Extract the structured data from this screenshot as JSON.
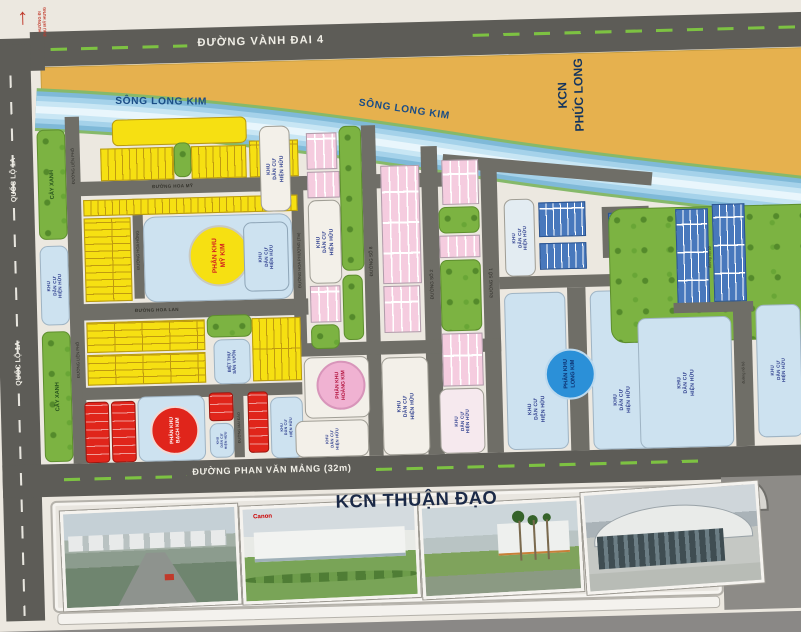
{
  "sign": {
    "arrow": "↑",
    "l1": "HƯỚNG ĐI",
    "l2": "PHÚ MỸ HƯNG"
  },
  "roads": {
    "vanh_dai_4": "ĐƯỜNG VÀNH ĐAI 4",
    "quoc_lo_1a": "QUỐC LỘ 1A",
    "phan_van_mang": "ĐƯỜNG PHAN VĂN MẢNG (32m)",
    "hoa_my": "ĐƯỜNG HOA MỸ",
    "hoa_lan": "ĐƯỜNG HOA LAN",
    "hoa_hong": "ĐƯỜNG HOA HỒNG",
    "hoa_phuong": "ĐƯỜNG HOA PHƯỢNG (7m)",
    "so_1": "ĐƯỜNG SỐ 1",
    "so_2": "ĐƯỜNG SỐ 2",
    "so_8": "ĐƯỜNG SỐ 8",
    "lien_pho": "ĐƯỜNG LIÊN PHỐ",
    "mai_dao": "ĐƯỜNG MAI ĐÀO",
    "noi_bo": "đường nội bộ"
  },
  "river": {
    "label": "SÔNG LONG KIM"
  },
  "industrial": {
    "phuc_long_l1": "KCN",
    "phuc_long_l2": "PHÚC LONG",
    "thuan_dao": "KCN THUẬN ĐẠO"
  },
  "zones": {
    "my_kim": {
      "l1": "PHÂN KHU",
      "l2": "MỸ KIM"
    },
    "hoang_kim": {
      "l1": "PHÂN KHU",
      "l2": "HOÀNG KIM"
    },
    "bach_kim": {
      "l1": "PHÂN KHU",
      "l2": "BẠCH KIM"
    },
    "long_kim": {
      "l1": "PHÂN KHU",
      "l2": "LONG KIM"
    }
  },
  "labels": {
    "kdc": {
      "l1": "KHU",
      "l2": "DÂN CƯ",
      "l3": "HIỆN HỮU"
    },
    "cay_xanh": "CÂY XANH",
    "biet_thu": {
      "l1": "BIỆT THỰ",
      "l2": "SÂN VƯỜN"
    }
  },
  "photos": {
    "canon_logo": "Canon"
  },
  "colors": {
    "yellow": "#f6e012",
    "pink": "#f5ccdf",
    "red": "#e0251b",
    "blue_lots": "#4878bc",
    "green": "#7cb342",
    "orange": "#e6b14e",
    "river": "#8ec6e2",
    "light_blue": "#cde2f0",
    "road": "#5d5c57"
  }
}
